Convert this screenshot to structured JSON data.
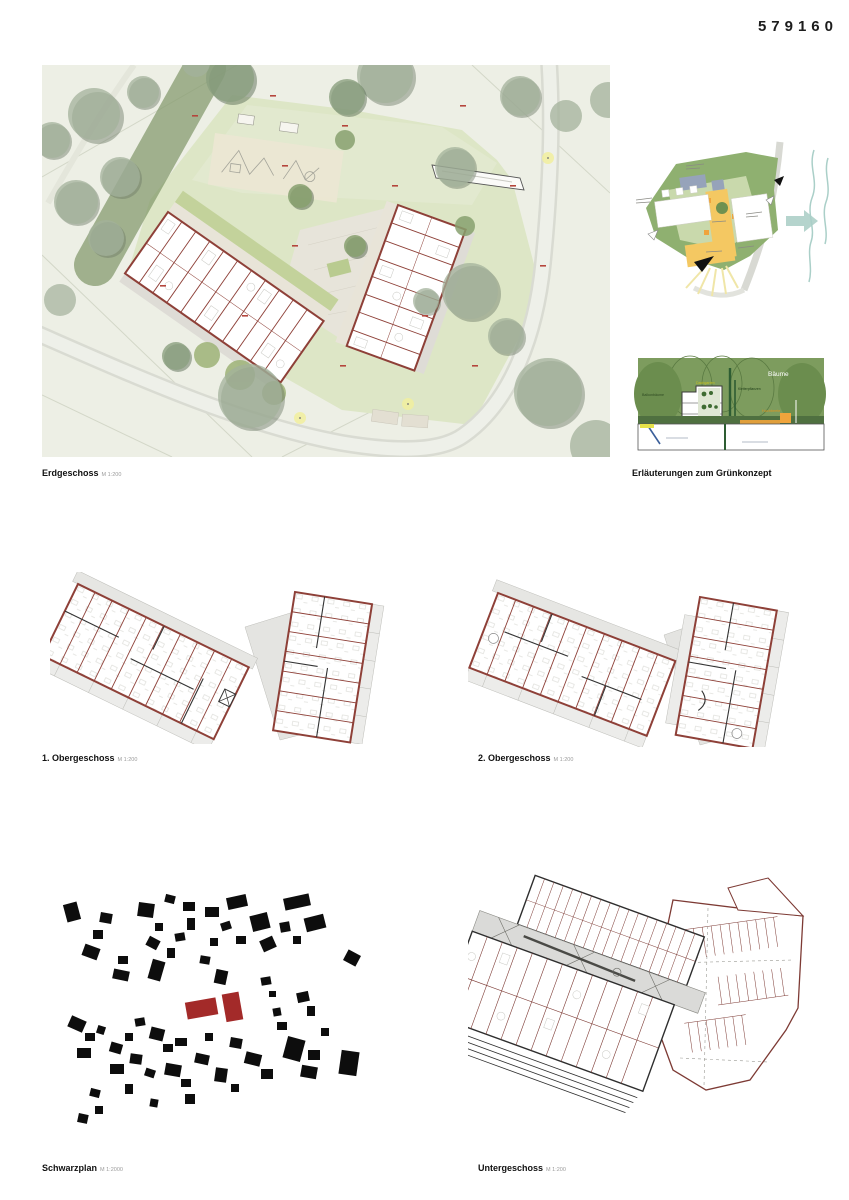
{
  "sheet": {
    "id_number": "579160"
  },
  "panels": {
    "erdgeschoss": {
      "title": "Erdgeschoss",
      "scale": "M 1:200"
    },
    "gruenkonzept": {
      "title": "Erläuterungen zum Grünkonzept",
      "scale": ""
    },
    "og1": {
      "title": "1. Obergeschoss",
      "scale": "M 1:200"
    },
    "og2": {
      "title": "2. Obergeschoss",
      "scale": "M 1:200"
    },
    "schwarzplan": {
      "title": "Schwarzplan",
      "scale": "M 1:2000"
    },
    "untergeschoss": {
      "title": "Untergeschoss",
      "scale": "M 1:200"
    }
  },
  "section_labels": {
    "baeume": "Bäume",
    "balkonbaeume": "Balkonbäume",
    "dachgarten": "Dachgarten",
    "kletterpflanzen": "Kletterpflanzen",
    "hochbeete": "Hochbeete"
  },
  "colors": {
    "wall_maroon": "#8e4038",
    "project_red": "#a32a29",
    "site_ground": "#edefe5",
    "site_lawn": "#dde6c6",
    "tree_green": "#93a58b",
    "hedge_green": "#83996c",
    "section_green": "#7d9c5e",
    "concept_yellow": "#f4c862",
    "concept_green": "#8fb070",
    "water_teal": "#aacfc8",
    "accent_orange": "#f0a43c"
  }
}
